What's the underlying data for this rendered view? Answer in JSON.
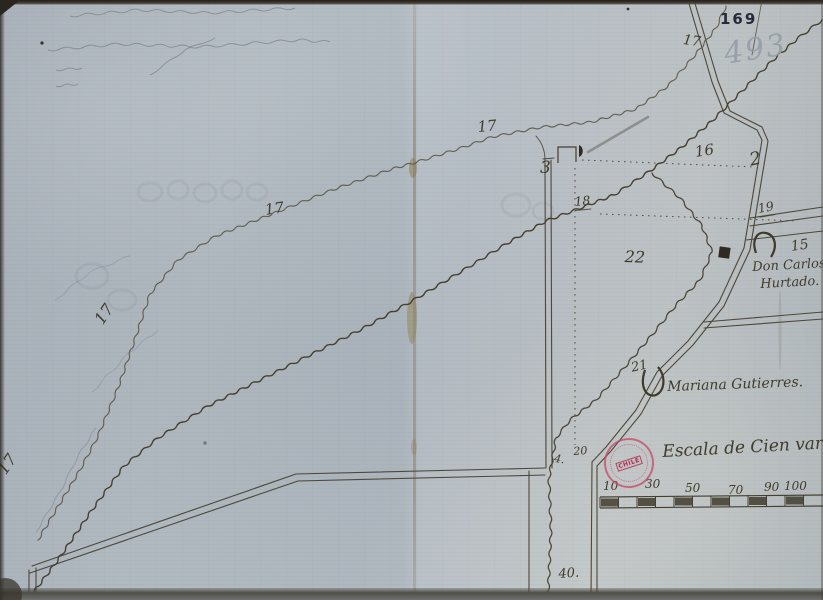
{
  "document": {
    "folio_stamp": "169",
    "folio_pencil": "493"
  },
  "map": {
    "parcel_numbers": {
      "n2": "2",
      "n3": "3",
      "n4": "4.",
      "n15": "15",
      "n16": "16",
      "n17": "17",
      "n18": "18",
      "n19": "19",
      "n20": "20",
      "n21": "21",
      "n22": "22",
      "n40": "40."
    },
    "owners": {
      "owner1_line1": "Don Carlos",
      "owner1_line2": "Hurtado.",
      "owner2": "Mariana Gutierres."
    },
    "scale": {
      "title": "Escala de Cien varas",
      "ticks": [
        "10",
        "30",
        "50",
        "70",
        "90",
        "100"
      ]
    },
    "stamp": {
      "center_text": "CHILE"
    }
  }
}
